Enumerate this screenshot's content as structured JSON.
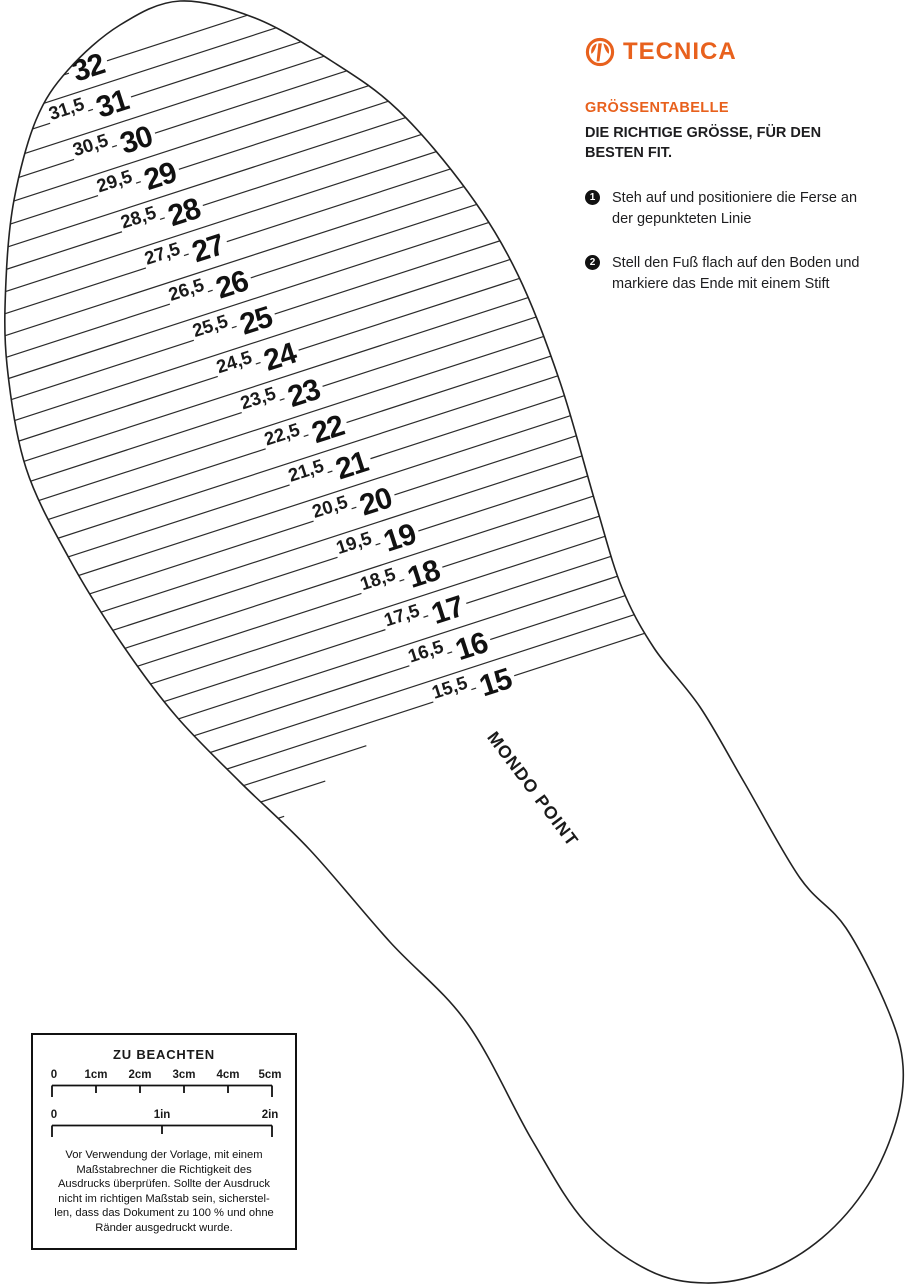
{
  "brand": {
    "name": "TECNICA",
    "accent_color": "#E8611D"
  },
  "panel": {
    "heading": "GRÖSSENTABELLE",
    "subheading": "DIE RICHTIGE GRÖSSE, FÜR DEN BESTEN FIT.",
    "steps": [
      {
        "num": "1",
        "text": "Steh auf und positioniere die Ferse an der gepunkteten Linie"
      },
      {
        "num": "2",
        "text": "Stell den Fuß flach auf den Boden und markiere das Ende mit einem Stift"
      }
    ]
  },
  "figure": {
    "axis_label": "MONDO POINT",
    "sizes_whole": [
      "32",
      "31",
      "30",
      "29",
      "28",
      "27",
      "26",
      "25",
      "24",
      "23",
      "22",
      "21",
      "20",
      "19",
      "18",
      "17",
      "16",
      "15"
    ],
    "sizes_half": [
      "31,5",
      "30,5",
      "29,5",
      "28,5",
      "27,5",
      "26,5",
      "25,5",
      "24,5",
      "23,5",
      "22,5",
      "21,5",
      "20,5",
      "19,5",
      "18,5",
      "17,5",
      "16,5",
      "15,5"
    ]
  },
  "notice": {
    "title": "ZU BEACHTEN",
    "cm_labels": [
      "0",
      "1cm",
      "2cm",
      "3cm",
      "4cm",
      "5cm"
    ],
    "in_labels": [
      "0",
      "1in",
      "2in"
    ],
    "body_lines": [
      "Vor Verwendung der Vorlage, mit einem",
      "Maßstabrechner die Richtigkeit des",
      "Ausdrucks überprüfen. Sollte der Ausdruck",
      "nicht im richtigen Maßstab sein, sicherstel-",
      "len, dass das Dokument zu 100 % und ohne",
      "Ränder ausgedruckt wurde."
    ]
  }
}
